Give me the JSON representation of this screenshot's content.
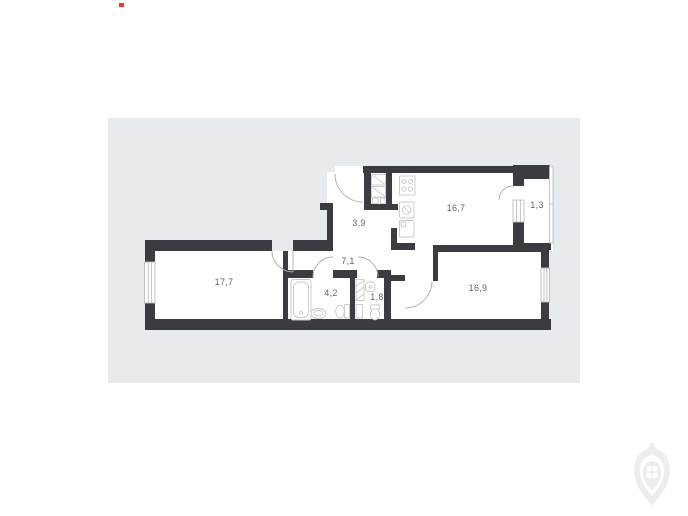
{
  "panel": {
    "background": "#e8ebee"
  },
  "colors": {
    "wall": "#3b3b41",
    "fixture": "#c6cacd",
    "door": "#a9adb2",
    "window_frame": "#b9bdc2",
    "label": "#5f6368",
    "logo": "#ededee",
    "red_marker": "#e8372c"
  },
  "floorplan": {
    "rooms": [
      {
        "name": "living-room",
        "area_label": "17,7"
      },
      {
        "name": "bathroom",
        "area_label": "4,2"
      },
      {
        "name": "hallway",
        "area_label": "7,1"
      },
      {
        "name": "wc",
        "area_label": "1,8"
      },
      {
        "name": "entry-hall",
        "area_label": "3,9"
      },
      {
        "name": "kitchen",
        "area_label": "16,7"
      },
      {
        "name": "balcony",
        "area_label": "1,3"
      },
      {
        "name": "bedroom",
        "area_label": "16,9"
      }
    ]
  }
}
